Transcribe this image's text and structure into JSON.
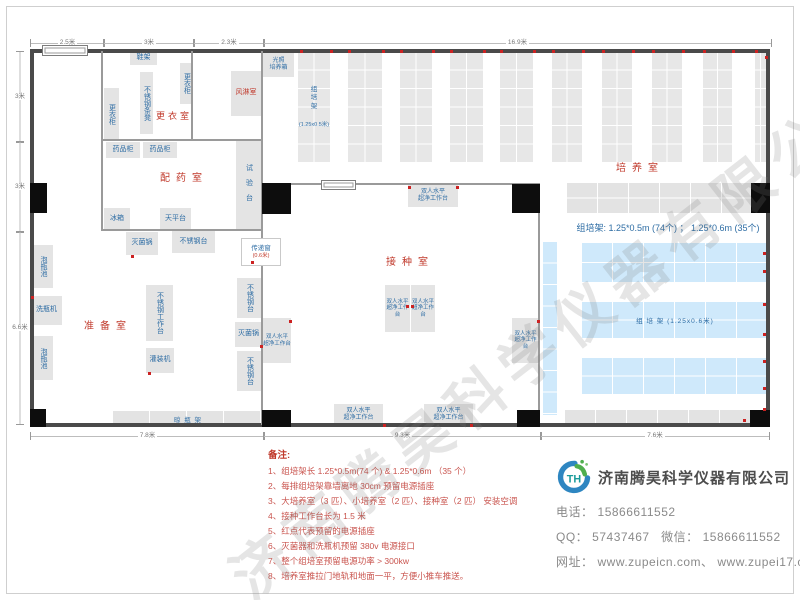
{
  "watermark": "济南腾昊科学仪器有限公司",
  "colors": {
    "room_label_red": "#c0392b",
    "equipment_blue": "#2e6da4",
    "rack_blue": "#cfe9fb",
    "outlet_red": "#cc2222"
  },
  "dims": {
    "top": [
      {
        "t": "2.5米",
        "x": 30,
        "w": 73
      },
      {
        "t": "3米",
        "x": 103,
        "w": 90
      },
      {
        "t": "2.3米",
        "x": 193,
        "w": 70
      },
      {
        "t": "16.9米",
        "x": 263,
        "w": 507
      }
    ],
    "left": [
      {
        "t": "3米",
        "y": 51,
        "h": 90
      },
      {
        "t": "3米",
        "y": 141,
        "h": 90
      },
      {
        "t": "6.6米",
        "y": 231,
        "h": 192
      }
    ],
    "bottom": [
      {
        "t": "7.8米",
        "x": 30,
        "w": 233
      },
      {
        "t": "9.3米",
        "x": 263,
        "w": 277
      },
      {
        "t": "7.6米",
        "x": 540,
        "w": 228
      }
    ]
  },
  "rooms": [
    {
      "n": "room-label-changing",
      "t": "更衣室",
      "x": 144,
      "y": 112,
      "w": 60,
      "fs": 9,
      "ls": 3
    },
    {
      "n": "room-label-dispensing",
      "t": "配药室",
      "x": 142,
      "y": 174,
      "w": 84,
      "fs": 10,
      "ls": 6
    },
    {
      "n": "room-label-preparation",
      "t": "准备室",
      "x": 66,
      "y": 322,
      "w": 84,
      "fs": 10,
      "ls": 6
    },
    {
      "n": "room-label-inoculation",
      "t": "接种室",
      "x": 368,
      "y": 258,
      "w": 84,
      "fs": 10,
      "ls": 6
    },
    {
      "n": "room-label-culture",
      "t": "培养室",
      "x": 598,
      "y": 164,
      "w": 84,
      "fs": 10,
      "ls": 6
    }
  ],
  "equipment": [
    {
      "n": "shoe-rack",
      "t": "鞋架",
      "x": 130,
      "y": 52,
      "w": 27,
      "h": 13
    },
    {
      "n": "locker-right",
      "t": "更衣柜",
      "x": 180,
      "y": 63,
      "w": 13,
      "h": 41,
      "v": 1
    },
    {
      "n": "steel-bench",
      "t": "不锈钢条凳",
      "x": 140,
      "y": 72,
      "w": 13,
      "h": 62,
      "v": 1
    },
    {
      "n": "locker-left",
      "t": "更衣柜",
      "x": 104,
      "y": 88,
      "w": 15,
      "h": 53,
      "v": 1
    },
    {
      "n": "air-shower",
      "t": "风淋室",
      "x": 231,
      "y": 71,
      "w": 30,
      "h": 45,
      "red": 1
    },
    {
      "n": "light-incubator",
      "t": "光照\n培养箱",
      "x": 263,
      "y": 52,
      "w": 31,
      "h": 25,
      "fs": 6
    },
    {
      "n": "medicine-cabinet-1",
      "t": "药品柜",
      "x": 106,
      "y": 142,
      "w": 34,
      "h": 16
    },
    {
      "n": "medicine-cabinet-2",
      "t": "药品柜",
      "x": 143,
      "y": 142,
      "w": 34,
      "h": 16
    },
    {
      "n": "test-bench",
      "t": "试验台",
      "x": 236,
      "y": 141,
      "w": 25,
      "h": 90,
      "v": 1,
      "ls": 8
    },
    {
      "n": "fridge",
      "t": "冰箱",
      "x": 104,
      "y": 208,
      "w": 26,
      "h": 22
    },
    {
      "n": "balance-table",
      "t": "天平台",
      "x": 160,
      "y": 208,
      "w": 31,
      "h": 22
    },
    {
      "n": "sterilizer-1",
      "t": "灭菌锅",
      "x": 126,
      "y": 232,
      "w": 32,
      "h": 23
    },
    {
      "n": "steel-table-1",
      "t": "不锈钢台",
      "x": 172,
      "y": 231,
      "w": 43,
      "h": 22
    },
    {
      "n": "steel-worktable",
      "t": "不锈钢工作台",
      "x": 146,
      "y": 285,
      "w": 27,
      "h": 56,
      "v": 1
    },
    {
      "n": "filling-machine",
      "t": "灌装机",
      "x": 146,
      "y": 348,
      "w": 28,
      "h": 25
    },
    {
      "n": "steel-table-2",
      "t": "不锈钢台",
      "x": 237,
      "y": 278,
      "w": 25,
      "h": 40,
      "v": 1
    },
    {
      "n": "sterilizer-2",
      "t": "灭菌锅",
      "x": 235,
      "y": 322,
      "w": 27,
      "h": 25
    },
    {
      "n": "steel-table-3",
      "t": "不锈钢台",
      "x": 237,
      "y": 351,
      "w": 25,
      "h": 40,
      "v": 1
    },
    {
      "n": "soak-pool-1",
      "t": "泡瓶池",
      "x": 33,
      "y": 245,
      "w": 20,
      "h": 43,
      "v": 1
    },
    {
      "n": "bottle-washer",
      "t": "洗瓶机",
      "x": 31,
      "y": 296,
      "w": 31,
      "h": 29
    },
    {
      "n": "soak-pool-2",
      "t": "泡瓶池",
      "x": 33,
      "y": 336,
      "w": 20,
      "h": 44,
      "v": 1
    },
    {
      "n": "clean-bench-top",
      "t": "双人水平\n超净工作台",
      "x": 408,
      "y": 185,
      "w": 50,
      "h": 22,
      "fs": 6
    },
    {
      "n": "clean-bench-center-left",
      "t": "双人水平\n超净工作台",
      "x": 385,
      "y": 285,
      "w": 25,
      "h": 47,
      "fs": 5.5
    },
    {
      "n": "clean-bench-center-right",
      "t": "双人水平\n超净工作台",
      "x": 411,
      "y": 285,
      "w": 24,
      "h": 47,
      "fs": 5.5
    },
    {
      "n": "clean-bench-west",
      "t": "双人水平\n超净工作台",
      "x": 263,
      "y": 318,
      "w": 28,
      "h": 45,
      "fs": 5.5
    },
    {
      "n": "clean-bench-east",
      "t": "双人水平\n超净工作台",
      "x": 512,
      "y": 318,
      "w": 27,
      "h": 45,
      "fs": 5.5
    },
    {
      "n": "clean-bench-south-1",
      "t": "双人水平\n超净工作台",
      "x": 334,
      "y": 404,
      "w": 49,
      "h": 21,
      "fs": 6
    },
    {
      "n": "clean-bench-south-2",
      "t": "双人水平\n超净工作台",
      "x": 424,
      "y": 404,
      "w": 49,
      "h": 21,
      "fs": 6
    }
  ],
  "pass_window": {
    "n": "pass-through-window",
    "t": "传递窗",
    "sub": "(0.6米)",
    "x": 241,
    "y": 238,
    "w": 38,
    "h": 26
  },
  "racks": [
    {
      "n": "culture-rack-column",
      "k": "gcol",
      "x": 298,
      "y": 52,
      "w": 32,
      "h": 111
    },
    {
      "n": "culture-rack-column",
      "k": "gcol",
      "x": 348,
      "y": 52,
      "w": 34,
      "h": 111
    },
    {
      "n": "culture-rack-column",
      "k": "gcol",
      "x": 400,
      "y": 52,
      "w": 32,
      "h": 111
    },
    {
      "n": "culture-rack-column",
      "k": "gcol",
      "x": 450,
      "y": 52,
      "w": 33,
      "h": 111
    },
    {
      "n": "culture-rack-column",
      "k": "gcol",
      "x": 500,
      "y": 52,
      "w": 33,
      "h": 111
    },
    {
      "n": "culture-rack-column",
      "k": "gcol",
      "x": 552,
      "y": 52,
      "w": 30,
      "h": 111
    },
    {
      "n": "culture-rack-column",
      "k": "gcol",
      "x": 602,
      "y": 52,
      "w": 30,
      "h": 111
    },
    {
      "n": "culture-rack-column",
      "k": "gcol",
      "x": 652,
      "y": 52,
      "w": 30,
      "h": 111
    },
    {
      "n": "culture-rack-column",
      "k": "gcol",
      "x": 703,
      "y": 52,
      "w": 29,
      "h": 111
    },
    {
      "n": "culture-rack-column",
      "k": "gcol",
      "x": 755,
      "y": 52,
      "w": 11,
      "h": 111
    },
    {
      "n": "culture-rack-row-top",
      "k": "ghor",
      "x": 567,
      "y": 183,
      "w": 185,
      "h": 30
    },
    {
      "n": "culture-rack-row-bottom",
      "k": "gbot",
      "x": 565,
      "y": 410,
      "w": 187,
      "h": 15
    },
    {
      "n": "bottle-drying-rack",
      "k": "shelf",
      "x": 113,
      "y": 411,
      "w": 150,
      "h": 15,
      "t": "晾  瓶  架"
    },
    {
      "n": "blue-rack-vertical",
      "k": "bver",
      "x": 543,
      "y": 242,
      "w": 14,
      "h": 173
    },
    {
      "n": "blue-rack-row-1",
      "k": "bhor",
      "x": 582,
      "y": 243,
      "w": 186,
      "h": 39
    },
    {
      "n": "blue-rack-row-2",
      "k": "bhor",
      "x": 582,
      "y": 302,
      "w": 186,
      "h": 36,
      "t": "组  培  架 (1.25x0.6米)"
    },
    {
      "n": "blue-rack-row-3",
      "k": "bhor",
      "x": 582,
      "y": 358,
      "w": 186,
      "h": 36
    }
  ],
  "annotations": [
    {
      "n": "rack-spec-note",
      "t": "组培架: 1.25*0.5m (74个) ； 1.25*0.6m (35个)",
      "x": 566,
      "y": 223,
      "w": 204,
      "fs": 9,
      "c": "#2e6da4"
    },
    {
      "n": "rack-column-label",
      "t": "组\n培\n架",
      "x": 300,
      "y": 86,
      "w": 28,
      "fs": 6.5,
      "c": "#2e6da4"
    },
    {
      "n": "rack-column-sub-label",
      "t": "(1.25x0.5米)",
      "x": 293,
      "y": 122,
      "w": 42,
      "fs": 5.5,
      "c": "#2e6da4"
    }
  ],
  "doors": {
    "white": [
      [
        42,
        45,
        44,
        9
      ],
      [
        321,
        180,
        33,
        8
      ]
    ],
    "black": [
      [
        30,
        183,
        17,
        30
      ],
      [
        262,
        183,
        29,
        31
      ],
      [
        512,
        184,
        28,
        29
      ],
      [
        751,
        183,
        19,
        30
      ],
      [
        30,
        409,
        16,
        18
      ],
      [
        262,
        410,
        29,
        17
      ],
      [
        517,
        410,
        23,
        17
      ],
      [
        750,
        410,
        20,
        17
      ]
    ]
  },
  "outlets": [
    [
      300,
      50
    ],
    [
      330,
      50
    ],
    [
      348,
      50
    ],
    [
      382,
      50
    ],
    [
      400,
      50
    ],
    [
      432,
      50
    ],
    [
      450,
      50
    ],
    [
      483,
      50
    ],
    [
      500,
      50
    ],
    [
      533,
      50
    ],
    [
      552,
      50
    ],
    [
      582,
      50
    ],
    [
      602,
      50
    ],
    [
      632,
      50
    ],
    [
      652,
      50
    ],
    [
      682,
      50
    ],
    [
      703,
      50
    ],
    [
      732,
      50
    ],
    [
      755,
      50
    ],
    [
      765,
      56
    ],
    [
      408,
      186
    ],
    [
      456,
      186
    ],
    [
      406,
      305
    ],
    [
      411,
      305
    ],
    [
      383,
      424
    ],
    [
      470,
      424
    ],
    [
      537,
      320
    ],
    [
      289,
      320
    ],
    [
      131,
      255
    ],
    [
      148,
      372
    ],
    [
      260,
      345
    ],
    [
      251,
      261
    ],
    [
      31,
      296
    ],
    [
      763,
      252
    ],
    [
      763,
      270
    ],
    [
      763,
      303
    ],
    [
      763,
      333
    ],
    [
      763,
      360
    ],
    [
      763,
      387
    ],
    [
      763,
      408
    ],
    [
      743,
      419
    ]
  ],
  "notes": {
    "title": "备注:",
    "items": [
      "1、组培架长 1.25*0.5m(74 个) & 1.25*0.6m （35 个）",
      "2、每排组培架靠墙离地 30cm 预留电源插座",
      "3、大培养室（3 匹）、小培养室（2 匹）、接种室（2 匹） 安装空调",
      "4、接种工作台长为 1.5 米",
      "5、红点代表预留的电源插座",
      "6、灭菌器和洗瓶机预留 380v 电源接口",
      "7、整个组培室预留电源功率 > 300kw",
      "8、培养室推拉门地轨和地面一平，方便小推车推送。"
    ]
  },
  "company": {
    "logo_text": "TH",
    "name": "济南腾昊科学仪器有限公司",
    "tel_label": "电话：",
    "tel": "15866611552",
    "qq_label": "QQ：",
    "qq": "57437467",
    "wx_label": "微信：",
    "wx": "15866611552",
    "web_label": "网址：",
    "web": "www.zupeicn.com、 www.zupei17.com"
  }
}
